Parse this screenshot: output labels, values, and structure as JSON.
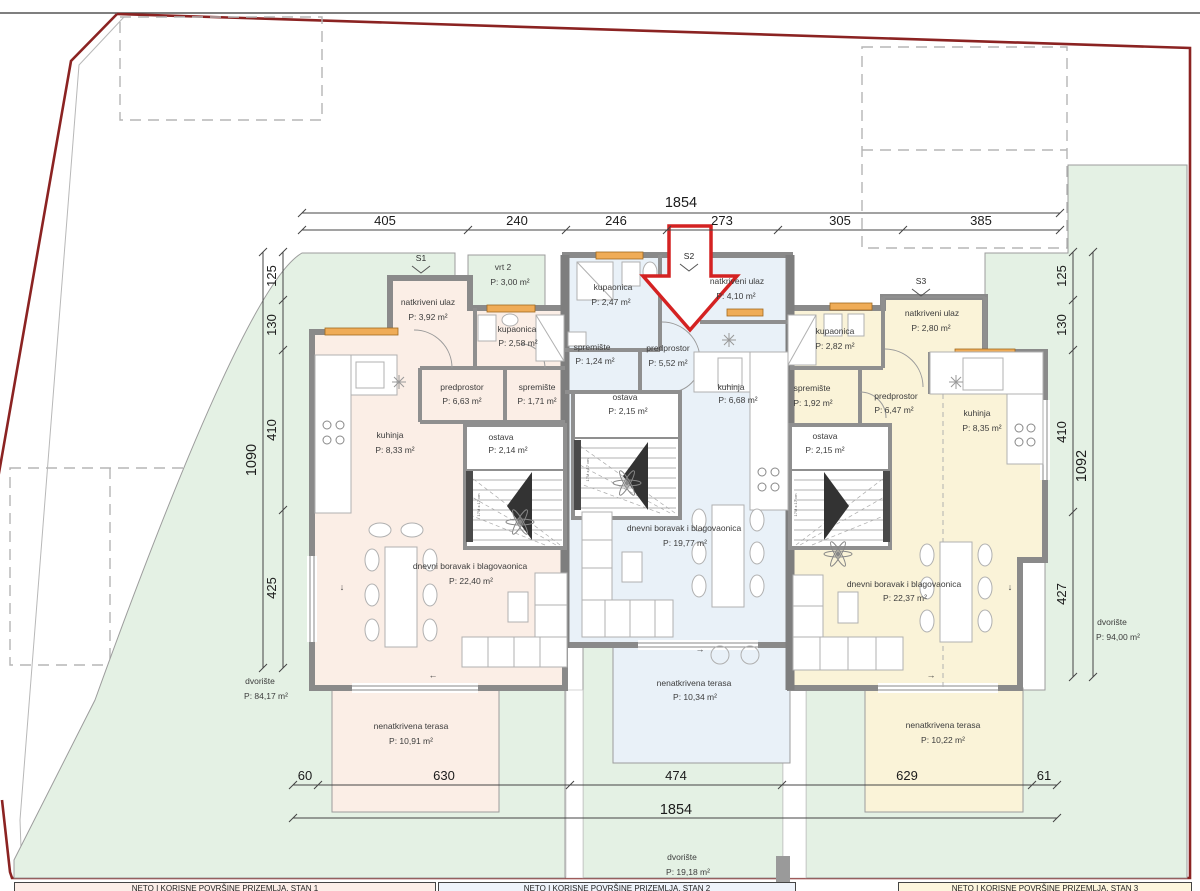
{
  "rooms": {
    "s1_ulaz": {
      "name": "natkriveni ulaz",
      "area": "P: 3,92 m²"
    },
    "s1_vrt": {
      "name": "vrt 2",
      "area": "P: 3,00 m²"
    },
    "s1_kupaonica": {
      "name": "kupaonica",
      "area": "P: 2,58 m²"
    },
    "s1_predprostor": {
      "name": "predprostor",
      "area": "P: 6,63 m²"
    },
    "s1_spremiste": {
      "name": "spremište",
      "area": "P: 1,71 m²"
    },
    "s1_kuhinja": {
      "name": "kuhinja",
      "area": "P: 8,33 m²"
    },
    "s1_ostava": {
      "name": "ostava",
      "area": "P: 2,14 m²"
    },
    "s1_dnevni": {
      "name": "dnevni boravak i blagovaonica",
      "area": "P: 22,40 m²"
    },
    "s1_terasa": {
      "name": "nenatkrivena terasa",
      "area": "P: 10,91 m²"
    },
    "s2_kupaonica": {
      "name": "kupaonica",
      "area": "P: 2,47 m²"
    },
    "s2_ulaz": {
      "name": "natkriveni ulaz",
      "area": "P: 4,10 m²"
    },
    "s2_spremiste": {
      "name": "spremište",
      "area": "P: 1,24 m²"
    },
    "s2_predprostor": {
      "name": "predprostor",
      "area": "P: 5,52 m²"
    },
    "s2_kuhinja": {
      "name": "kuhinja",
      "area": "P: 6,68 m²"
    },
    "s2_ostava": {
      "name": "ostava",
      "area": "P: 2,15 m²"
    },
    "s2_dnevni": {
      "name": "dnevni boravak i blagovaonica",
      "area": "P: 19,77 m²"
    },
    "s2_terasa": {
      "name": "nenatkrivena terasa",
      "area": "P: 10,34 m²"
    },
    "s3_kupaonica": {
      "name": "kupaonica",
      "area": "P: 2,82 m²"
    },
    "s3_ulaz": {
      "name": "natkriveni ulaz",
      "area": "P: 2,80 m²"
    },
    "s3_spremiste": {
      "name": "spremište",
      "area": "P: 1,92 m²"
    },
    "s3_predprostor": {
      "name": "predprostor",
      "area": "P: 6,47 m²"
    },
    "s3_kuhinja": {
      "name": "kuhinja",
      "area": "P: 8,35 m²"
    },
    "s3_ostava": {
      "name": "ostava",
      "area": "P: 2,15 m²"
    },
    "s3_dnevni": {
      "name": "dnevni boravak i blagovaonica",
      "area": "P: 22,37 m²"
    },
    "s3_terasa": {
      "name": "nenatkrivena terasa",
      "area": "P: 10,22 m²"
    },
    "dvoriste_left": {
      "name": "dvorište",
      "area": "P: 84,17 m²"
    },
    "dvoriste_right": {
      "name": "dvorište",
      "area": "P: 94,00 m²"
    },
    "dvoriste_bottom": {
      "name": "dvorište",
      "area": "P: 19,18 m²"
    }
  },
  "markers": {
    "s1": "S1",
    "s2": "S2",
    "s3": "S3"
  },
  "dims": {
    "top_total": "1854",
    "bottom_total": "1854",
    "left_total": "1090",
    "right_total": "1092",
    "top": [
      "405",
      "240",
      "246",
      "273",
      "305",
      "385"
    ],
    "bottom": [
      "60",
      "630",
      "474",
      "629",
      "61"
    ],
    "left": [
      "125",
      "130",
      "410",
      "425"
    ],
    "right": [
      "125",
      "130",
      "410",
      "427"
    ]
  },
  "stairs_note": "17M x 17 cm",
  "misc": {
    "arrow_left": "←",
    "arrow_right": "→",
    "arrow_down": "↓"
  },
  "footer": {
    "stan1": "NETO I KORISNE POVRŠINE PRIZEMLJA, STAN 1",
    "stan2": "NETO I KORISNE POVRŠINE PRIZEMLJA, STAN 2",
    "stan3": "NETO I KORISNE POVRŠINE PRIZEMLJA, STAN 3"
  },
  "colors": {
    "unit1": "#fbeee6",
    "unit2": "#e9f1f8",
    "unit3": "#faf3d8",
    "garden": "#e4f1e4",
    "boundary": "#8b2322",
    "arrow": "#d42222",
    "window": "#efac57"
  }
}
